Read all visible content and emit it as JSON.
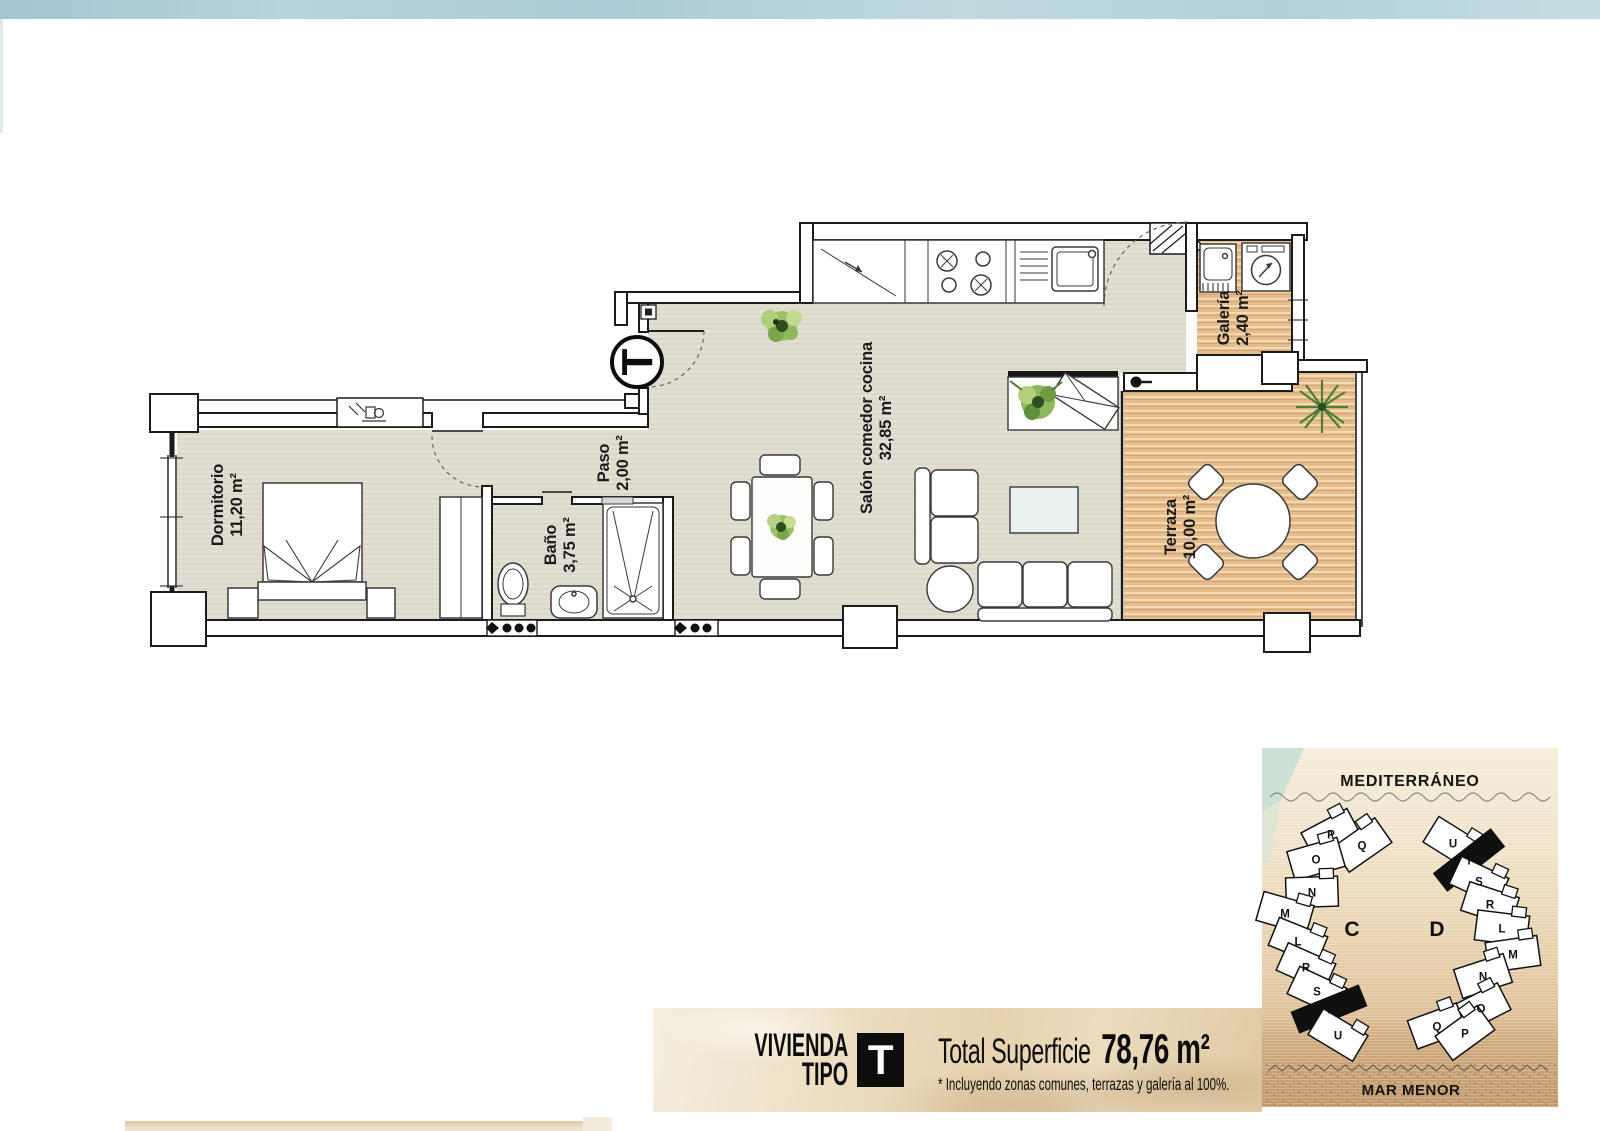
{
  "page": {
    "background": "#ffffff"
  },
  "floor_plan": {
    "entrance_symbol": "T",
    "colors": {
      "interior_floor": "#e0ddd0",
      "wood_floor": "#e5bc8c",
      "wall": "#1b1b1b",
      "plant": "#7fae4e"
    },
    "rooms": [
      {
        "id": "dormitorio",
        "label": "Dormitorio",
        "area": "11,20 m²",
        "x": 227,
        "y": 505
      },
      {
        "id": "paso",
        "label": "Paso",
        "area": "2,00 m²",
        "x": 613,
        "y": 463
      },
      {
        "id": "bano",
        "label": "Baño",
        "area": "3,75 m²",
        "x": 560,
        "y": 545
      },
      {
        "id": "salon",
        "label": "Salón comedor cocina",
        "area": "32,85 m²",
        "x": 876,
        "y": 428
      },
      {
        "id": "galeria",
        "label": "Galería",
        "area": "2,40 m²",
        "x": 1233,
        "y": 318
      },
      {
        "id": "terraza",
        "label": "Terraza",
        "area": "10,00 m²",
        "x": 1180,
        "y": 527
      }
    ]
  },
  "banner": {
    "title_line1": "VIVIENDA",
    "title_line2": "TIPO",
    "type_letter": "T",
    "total_label": "Total Superficie",
    "total_value": "78,76 m²",
    "note": "* Incluyendo zonas comunes, terrazas y galería al 100%."
  },
  "site_map": {
    "sea_top": "MEDITERRÁNEO",
    "sea_bottom": "MAR MENOR",
    "buildings": [
      {
        "id": "c",
        "label": "C",
        "label_x": 1352,
        "label_y": 936,
        "units": [
          {
            "letter": "P",
            "x": 1331,
            "y": 834,
            "rot": -28
          },
          {
            "letter": "Q",
            "x": 1362,
            "y": 845,
            "rot": -35
          },
          {
            "letter": "O",
            "x": 1316,
            "y": 859,
            "rot": -16
          },
          {
            "letter": "N",
            "x": 1312,
            "y": 892,
            "rot": -2
          },
          {
            "letter": "M",
            "x": 1285,
            "y": 913,
            "rot": 16
          },
          {
            "letter": "L",
            "x": 1298,
            "y": 941,
            "rot": 22
          },
          {
            "letter": "R",
            "x": 1306,
            "y": 967,
            "rot": 24
          },
          {
            "letter": "S",
            "x": 1317,
            "y": 991,
            "rot": 25
          },
          {
            "letter": "T",
            "x": 1329,
            "y": 1009,
            "rot": -22,
            "highlight": true
          },
          {
            "letter": "U",
            "x": 1338,
            "y": 1035,
            "rot": 31
          }
        ]
      },
      {
        "id": "d",
        "label": "D",
        "label_x": 1437,
        "label_y": 936,
        "units": [
          {
            "letter": "U",
            "x": 1453,
            "y": 843,
            "rot": 32
          },
          {
            "letter": "T",
            "x": 1469,
            "y": 860,
            "rot": -38,
            "highlight": true
          },
          {
            "letter": "S",
            "x": 1479,
            "y": 881,
            "rot": 25
          },
          {
            "letter": "R",
            "x": 1490,
            "y": 904,
            "rot": 18
          },
          {
            "letter": "L",
            "x": 1502,
            "y": 928,
            "rot": 7
          },
          {
            "letter": "M",
            "x": 1513,
            "y": 954,
            "rot": -8
          },
          {
            "letter": "N",
            "x": 1483,
            "y": 976,
            "rot": -18
          },
          {
            "letter": "O",
            "x": 1481,
            "y": 1008,
            "rot": -27
          },
          {
            "letter": "Q",
            "x": 1437,
            "y": 1026,
            "rot": -20
          },
          {
            "letter": "P",
            "x": 1465,
            "y": 1033,
            "rot": -36
          }
        ]
      }
    ]
  }
}
